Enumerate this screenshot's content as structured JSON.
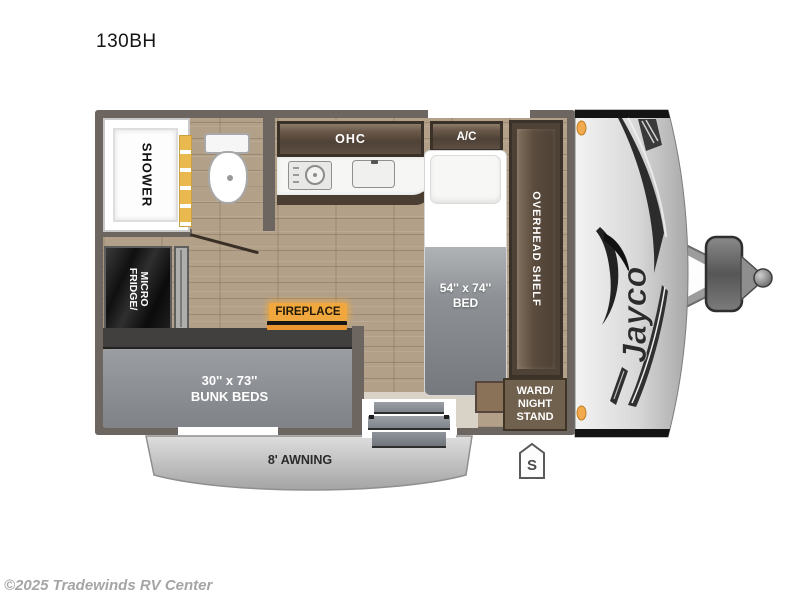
{
  "page": {
    "title": "130BH",
    "copyright": "©2025 Tradewinds RV Center"
  },
  "floorplan": {
    "brand_logo": "Jayco",
    "bathroom": {
      "shower_label": "SHOWER"
    },
    "fridge": {
      "line1": "FRIDGE/",
      "line2": "MICRO"
    },
    "kitchen": {
      "ohc_label": "OHC",
      "ac_label": "A/C"
    },
    "fireplace": {
      "label": "FIREPLACE"
    },
    "bed": {
      "size": "54'' x 74''",
      "name": "BED"
    },
    "overhead_shelf": {
      "label": "OVERHEAD SHELF"
    },
    "ward": {
      "line1": "WARD/",
      "line2": "NIGHT",
      "line3": "STAND"
    },
    "bunk": {
      "size": "30'' x 73''",
      "name": "BUNK BEDS"
    },
    "awning": {
      "label": "8' AWNING"
    },
    "stabilizer_marker": {
      "label": "S"
    },
    "colors": {
      "accent_amber": "#f0a83e",
      "clearance_light": "#f3a94d",
      "floor_wood": "#b2a089",
      "wall": "#6d6660",
      "cabinet_brown": "#4e4136",
      "bunk_gray": "#8b8f93",
      "fridge_black": "#1b1b1b"
    }
  }
}
